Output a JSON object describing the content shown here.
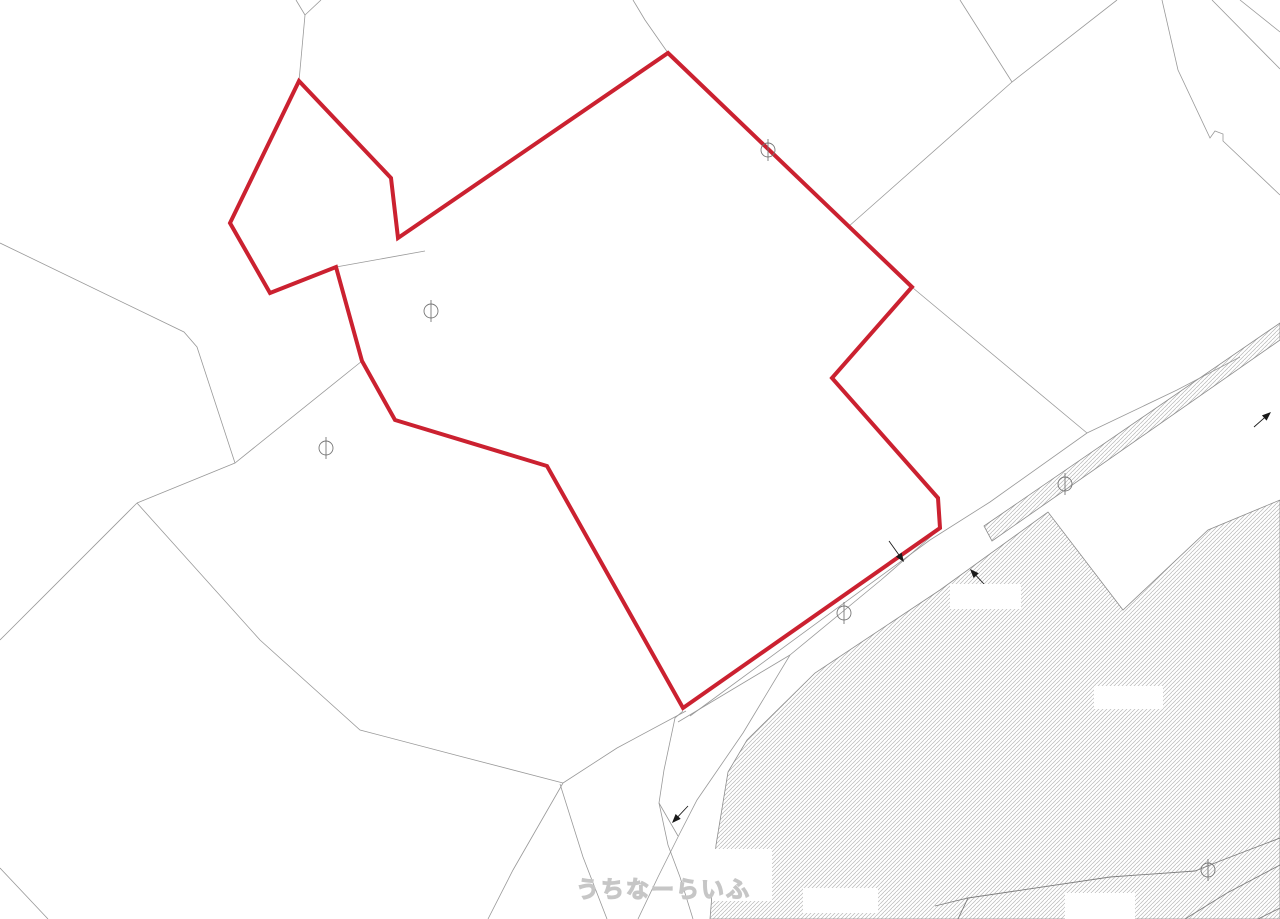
{
  "map": {
    "background_color": "#ffffff",
    "parcel_line_color": "#999999",
    "hatch_line_color": "#b9b9b9",
    "hatch_boundary_color": "#8d8d8d",
    "hatch_detail_color": "#7f7f7f",
    "marker_color": "#777777",
    "arrow_color": "#1a1a1a",
    "red_parcel": {
      "color": "#cb2130",
      "stroke_width": 4,
      "points": [
        [
          299,
          81
        ],
        [
          391,
          178
        ],
        [
          398,
          238
        ],
        [
          668,
          53
        ],
        [
          912,
          287
        ],
        [
          832,
          378
        ],
        [
          938,
          498
        ],
        [
          940,
          528
        ],
        [
          683,
          708
        ],
        [
          547,
          466
        ],
        [
          395,
          420
        ],
        [
          362,
          361
        ],
        [
          336,
          267
        ],
        [
          270,
          293
        ],
        [
          230,
          223
        ]
      ]
    },
    "parcel_lines": [
      [
        [
          296,
          0
        ],
        [
          305,
          15
        ],
        [
          299,
          81
        ]
      ],
      [
        [
          321,
          0
        ],
        [
          305,
          15
        ]
      ],
      [
        [
          633,
          0
        ],
        [
          645,
          20
        ],
        [
          668,
          53
        ]
      ],
      [
        [
          336,
          267
        ],
        [
          425,
          251
        ]
      ],
      [
        [
          0,
          243
        ],
        [
          184,
          332
        ],
        [
          197,
          347
        ],
        [
          235,
          463
        ]
      ],
      [
        [
          362,
          361
        ],
        [
          235,
          463
        ],
        [
          137,
          503
        ]
      ],
      [
        [
          137,
          503
        ],
        [
          0,
          640
        ]
      ],
      [
        [
          137,
          503
        ],
        [
          260,
          640
        ],
        [
          360,
          730
        ],
        [
          463,
          757
        ],
        [
          563,
          783
        ]
      ],
      [
        [
          563,
          783
        ],
        [
          617,
          748
        ],
        [
          686,
          711
        ]
      ],
      [
        [
          563,
          783
        ],
        [
          513,
          870
        ],
        [
          488,
          919
        ]
      ],
      [
        [
          560,
          784
        ],
        [
          583,
          857
        ],
        [
          607,
          919
        ]
      ],
      [
        [
          683,
          711
        ],
        [
          675,
          718
        ],
        [
          664,
          770
        ],
        [
          659,
          803
        ],
        [
          668,
          845
        ],
        [
          680,
          877
        ],
        [
          693,
          919
        ]
      ],
      [
        [
          659,
          803
        ],
        [
          678,
          836
        ]
      ],
      [
        [
          678,
          722
        ],
        [
          790,
          655
        ]
      ],
      [
        [
          935,
          533
        ],
        [
          881,
          580
        ],
        [
          790,
          655
        ],
        [
          743,
          733
        ],
        [
          697,
          800
        ],
        [
          680,
          833
        ],
        [
          658,
          877
        ],
        [
          638,
          919
        ]
      ],
      [
        [
          690,
          716
        ],
        [
          930,
          540
        ],
        [
          990,
          502
        ],
        [
          1087,
          433
        ],
        [
          1177,
          390
        ],
        [
          1240,
          357
        ]
      ],
      [
        [
          913,
          288
        ],
        [
          1087,
          433
        ]
      ],
      [
        [
          1117,
          0
        ],
        [
          1012,
          82
        ],
        [
          848,
          227
        ]
      ],
      [
        [
          960,
          0
        ],
        [
          1012,
          82
        ]
      ],
      [
        [
          1162,
          0
        ],
        [
          1178,
          70
        ],
        [
          1210,
          138
        ],
        [
          1215,
          131
        ],
        [
          1223,
          134
        ],
        [
          1223,
          141
        ],
        [
          1280,
          195
        ]
      ],
      [
        [
          1212,
          0
        ],
        [
          1280,
          69
        ]
      ],
      [
        [
          1240,
          0
        ],
        [
          1280,
          32
        ]
      ],
      [
        [
          0,
          868
        ],
        [
          48,
          919
        ]
      ]
    ],
    "hatch_areas": [
      {
        "points": [
          [
            710,
            919
          ],
          [
            716,
            845
          ],
          [
            728,
            772
          ],
          [
            747,
            740
          ],
          [
            815,
            673
          ],
          [
            940,
            590
          ],
          [
            1048,
            512
          ],
          [
            1123,
            610
          ],
          [
            1208,
            530
          ],
          [
            1280,
            500
          ],
          [
            1280,
            919
          ]
        ]
      },
      {
        "points": [
          [
            984,
            526
          ],
          [
            1280,
            323
          ],
          [
            1280,
            340
          ],
          [
            992,
            541
          ]
        ]
      }
    ],
    "hatch_detail_lines": [
      [
        [
          935,
          906
        ],
        [
          968,
          898
        ],
        [
          1110,
          877
        ],
        [
          1195,
          871
        ],
        [
          1220,
          861
        ],
        [
          1280,
          838
        ]
      ],
      [
        [
          968,
          898
        ],
        [
          958,
          919
        ]
      ],
      [
        [
          1185,
          919
        ],
        [
          1227,
          893
        ],
        [
          1280,
          865
        ]
      ],
      [
        [
          1258,
          919
        ],
        [
          1280,
          908
        ]
      ]
    ],
    "survey_markers": [
      {
        "x": 431,
        "y": 311
      },
      {
        "x": 326,
        "y": 448
      },
      {
        "x": 768,
        "y": 150
      },
      {
        "x": 844,
        "y": 613
      },
      {
        "x": 1065,
        "y": 484
      },
      {
        "x": 1208,
        "y": 870
      }
    ],
    "marker_radius": 7,
    "arrows": [
      {
        "tail": [
          889,
          541
        ],
        "tip": [
          904,
          562
        ]
      },
      {
        "tail": [
          984,
          584
        ],
        "tip": [
          970,
          569
        ]
      },
      {
        "tail": [
          1254,
          427
        ],
        "tip": [
          1271,
          412
        ]
      },
      {
        "tail": [
          688,
          806
        ],
        "tip": [
          672,
          823
        ]
      }
    ],
    "redaction_boxes": [
      {
        "x": 950,
        "y": 584,
        "w": 71,
        "h": 25
      },
      {
        "x": 1094,
        "y": 686,
        "w": 69,
        "h": 23
      },
      {
        "x": 803,
        "y": 888,
        "w": 75,
        "h": 25
      },
      {
        "x": 1065,
        "y": 893,
        "w": 70,
        "h": 26
      },
      {
        "x": 712,
        "y": 849,
        "w": 60,
        "h": 52
      },
      {
        "x": 175,
        "y": 907,
        "w": 88,
        "h": 12
      }
    ],
    "watermark": {
      "text": "うちなーらいふ",
      "x": 576,
      "y": 870,
      "font_size": 23
    }
  }
}
